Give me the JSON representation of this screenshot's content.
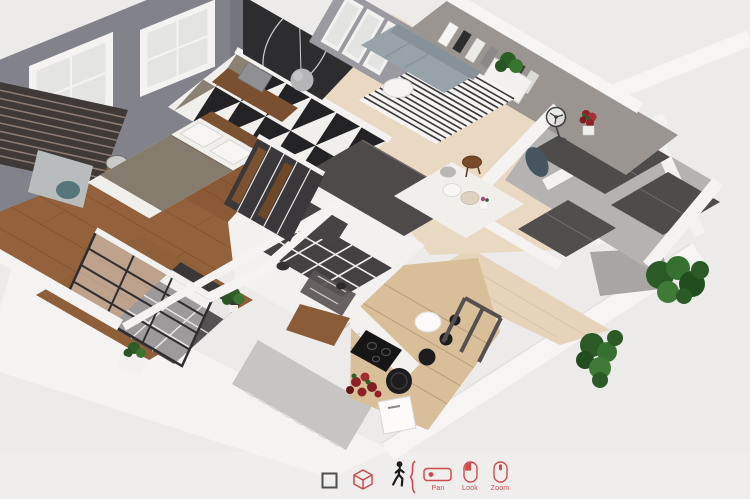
{
  "viewport": {
    "type": "3d-home-walkthrough-view",
    "background_color": "#ecebe9",
    "palette": {
      "wood_floor": "#93613b",
      "light_wood_floor": "#d8bf9a",
      "beige_floor": "#ead9c2",
      "terrace_floor": "#e6d4ba",
      "wall_white": "#f4f3f1",
      "wall_gray": "#82828a",
      "shelf_wall_gray": "#9a9591",
      "accent_black_wall": "#2d2c2e",
      "sofa_gray": "#98a2a9",
      "rug_stripe": "#3b3a3a",
      "tile_dark": "#454041",
      "wardrobe_dark": "#4e4b4b",
      "plant_green": "#2e5d28",
      "flower_red": "#8e2127",
      "exterior_shadow_gray": "#c7c5c3"
    },
    "scene_elements": [
      "master-bedroom-bed",
      "triangle-pattern-wall",
      "window-wall",
      "slatted-panel",
      "desk-with-chair",
      "floor-lamp",
      "pendant-lamp-wall",
      "bookshelf-wall",
      "sofa",
      "striped-rug",
      "side-table",
      "kitchen-island",
      "dining-table",
      "bathroom-tiles",
      "glass-partition-bedroom",
      "bed-two",
      "kitchen-counter",
      "cooktop",
      "pots",
      "wardrobe-panels",
      "fan",
      "flower-pots",
      "bushes",
      "terrace"
    ]
  },
  "toolbar": {
    "accent_color": "#cf4a4c",
    "icon_color_dark": "#4f4f4f",
    "icons": [
      {
        "name": "plan-2d-icon",
        "glyph": "square-outline"
      },
      {
        "name": "view-3d-cube-icon",
        "glyph": "wireframe-cube"
      },
      {
        "name": "walk-mode-icon",
        "glyph": "walking-person"
      },
      {
        "name": "mode-separator",
        "glyph": "curly-brace"
      }
    ],
    "hints": [
      {
        "icon": "trackpad-icon",
        "label": "Pan"
      },
      {
        "icon": "mouse-left-button-icon",
        "label": "Look"
      },
      {
        "icon": "mouse-scroll-icon",
        "label": "Zoom"
      }
    ]
  }
}
